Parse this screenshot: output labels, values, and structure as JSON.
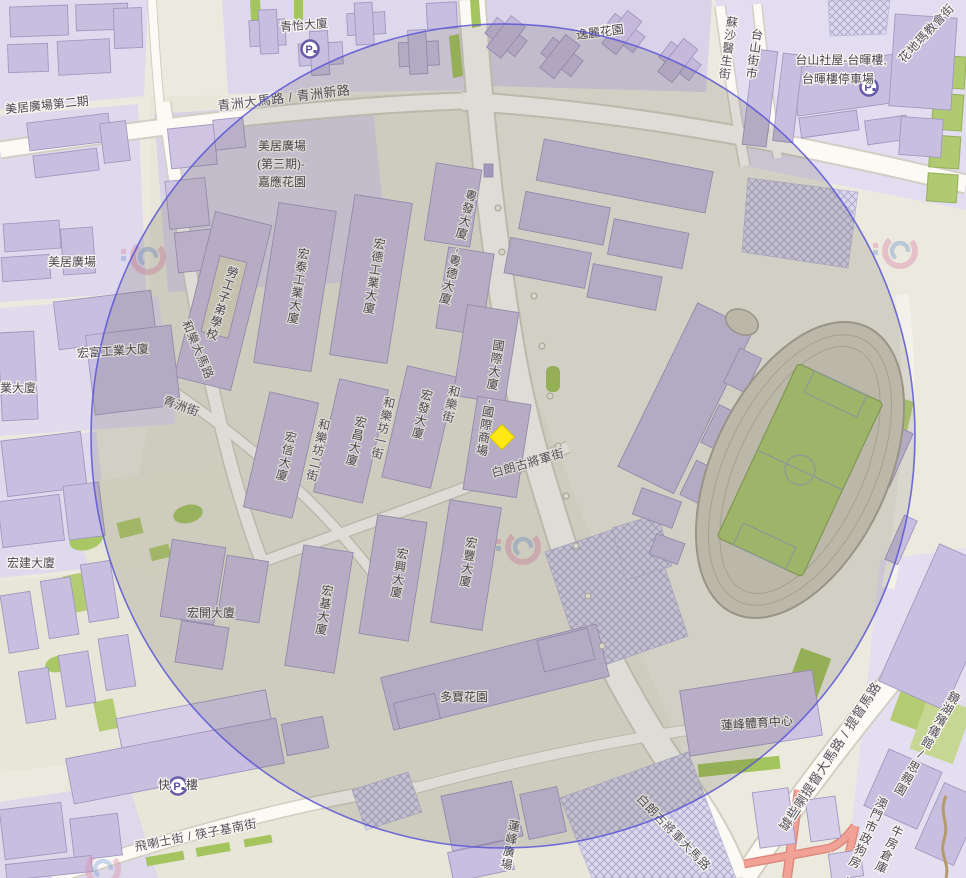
{
  "labels": {
    "qingyi": "青怡大廈",
    "yili": "逸麗花園",
    "taishan_social_line1": "台山社屋-台暉樓,",
    "taishan_social_line2": "台暉樓停車場",
    "meiju_phase2": "美居廣場第二期",
    "meiju_phase3_line1": "美居廣場",
    "meiju_phase3_line2": "(第三期)-",
    "meiju_phase3_line3": "嘉應花園",
    "meiju": "美居廣場",
    "hongfu": "宏富工業大廈",
    "partial_building": "業大廈",
    "hongjian": "宏建大廈",
    "hongkai": "宏開大廈",
    "duobao": "多寶花園",
    "lianfeng_sports": "蓮峰體育中心",
    "kuai_left": "快",
    "kuai_right": "樓",
    "laogong": "勞工子弟學校",
    "hongtai": "宏泰工業大廈",
    "hongde": "宏德工業大廈",
    "yuefa": "粵發大廈,粵德大廈",
    "guoji": "國際大廈,國際商場",
    "hongxin": "宏信大廈",
    "hongchang": "宏昌大廈",
    "hongfa": "宏發大廈",
    "hongji": "宏基大廈",
    "hongxing": "宏興大廈",
    "hongfeng": "宏豐大廈",
    "lianfeng_plaza": "蓮峰廣場",
    "kiang_wu": "鏡湖殯儀館/思親園",
    "gov_kennel": "澳門市政狗房,",
    "ox_warehouse": "牛房倉庫",
    "taishan_market": "台山街市",
    "parking": "P"
  },
  "roads": {
    "qingzhou_ave": "青洲大馬路 / 青洲新路",
    "helo_ave": "和樂大馬路",
    "qingzhou_st": "青洲街",
    "helo_st": "和樂街",
    "helo_fong1": "和樂坊一街",
    "helo_fong2": "和樂坊二街",
    "bailang_st": "白朗古將軍街",
    "bailang_ave": "白朗古將軍大馬路",
    "almirante_ave": "罅些喇提督大馬路 / 提督馬路",
    "feilashi": "飛喇士街 / 筷子基南街",
    "sousa": "蘇沙醫生街",
    "fatima": "花地瑪教會街"
  },
  "colors": {
    "radius_fill": "rgba(72,68,58,0.16)",
    "radius_stroke": "#5a56d6",
    "marker_fill": "#ffe813",
    "marker_stroke": "#d8c400"
  }
}
